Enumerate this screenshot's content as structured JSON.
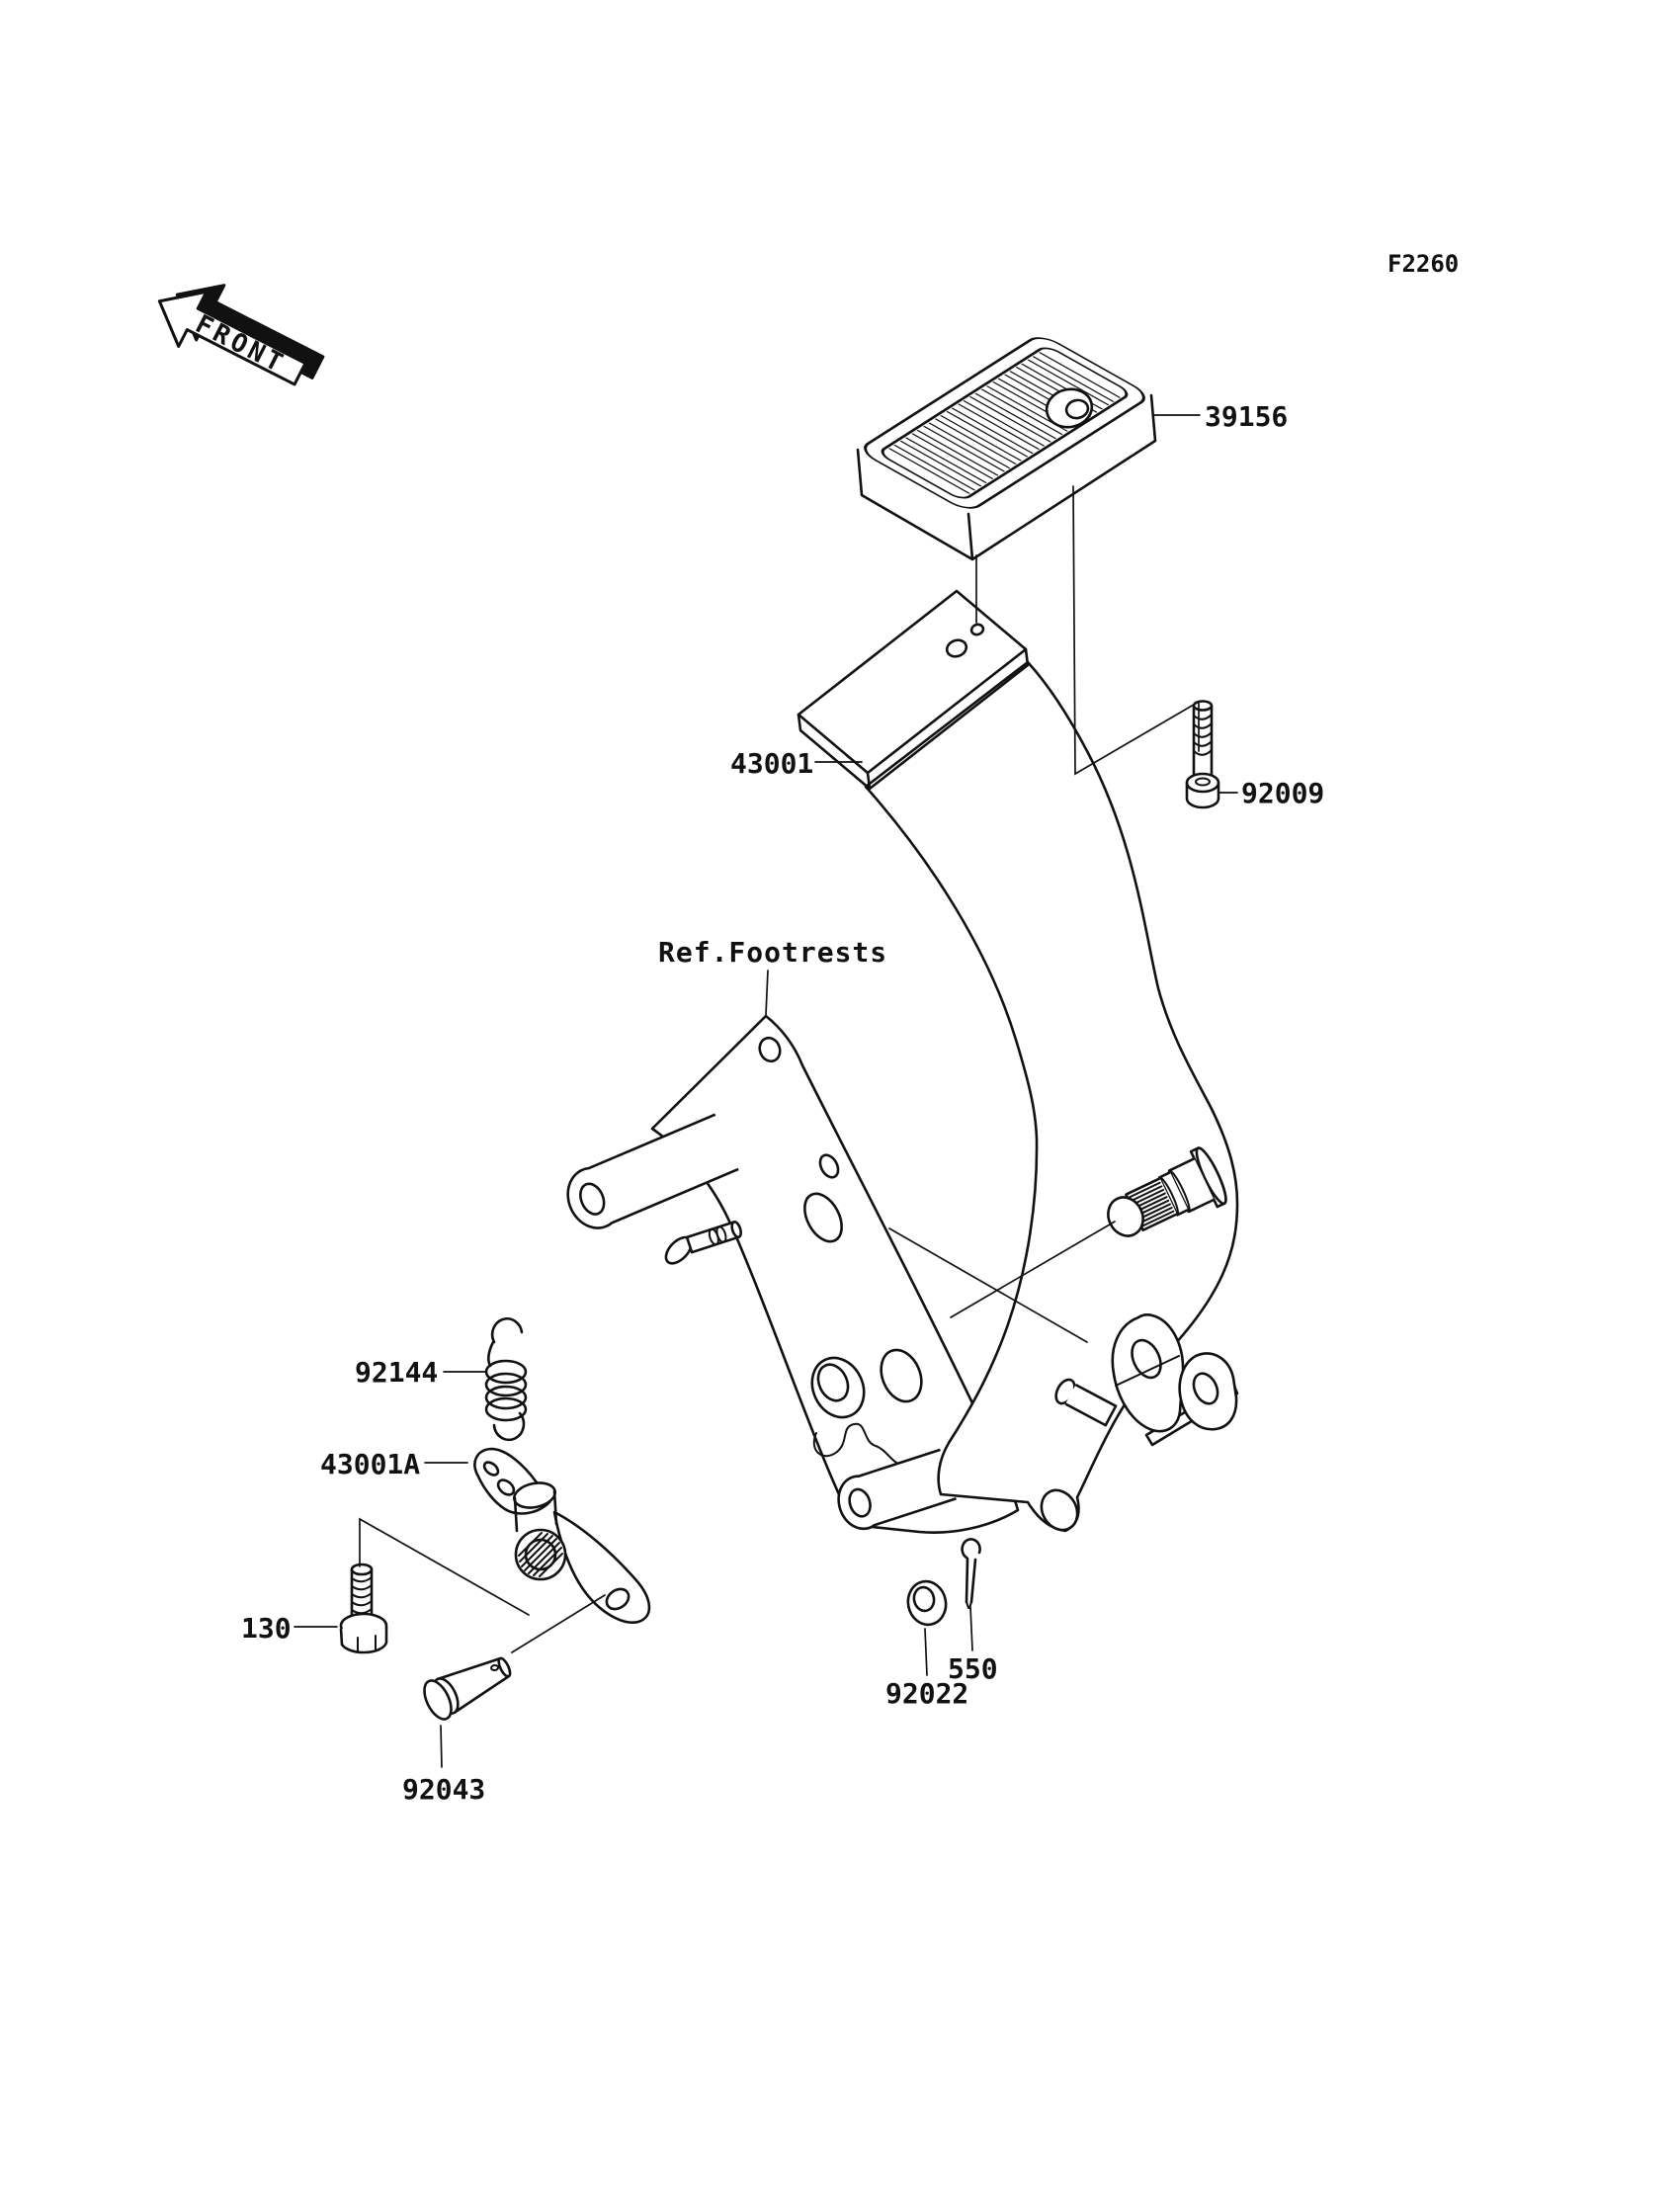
{
  "page": {
    "background_color": "#ffffff",
    "ink_color": "#111111"
  },
  "diagram": {
    "code": "F2260",
    "orientation_marker": "FRONT",
    "reference_note": "Ref.Footrests",
    "parts": [
      {
        "ref": "39156"
      },
      {
        "ref": "43001"
      },
      {
        "ref": "92009"
      },
      {
        "ref": "92144"
      },
      {
        "ref": "43001A"
      },
      {
        "ref": "130"
      },
      {
        "ref": "92043"
      },
      {
        "ref": "92022"
      },
      {
        "ref": "550"
      }
    ]
  }
}
